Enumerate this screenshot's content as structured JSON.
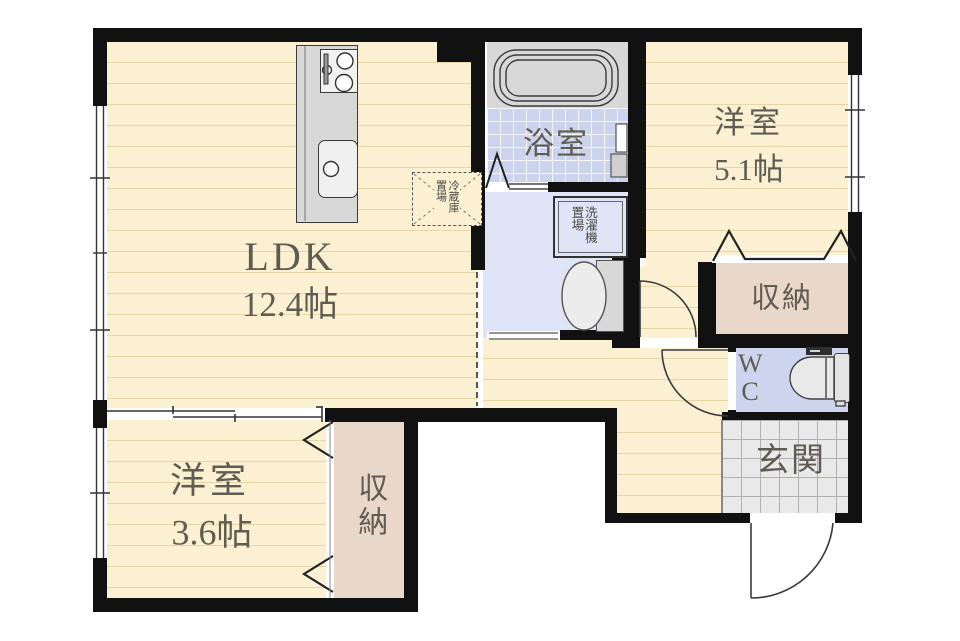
{
  "rooms": {
    "ldk": {
      "label": "LDK",
      "size": "12.4帖"
    },
    "bedroom_upper": {
      "label": "洋室",
      "size": "5.1帖"
    },
    "bedroom_lower": {
      "label": "洋室",
      "size": "3.6帖"
    },
    "bathroom": {
      "label": "浴室"
    },
    "entrance": {
      "label": "玄関"
    },
    "storage_upper": {
      "label": "収納"
    },
    "storage_lower": {
      "label": "収納"
    },
    "wc": {
      "line1": "W",
      "line2": "C"
    },
    "washer_space": {
      "label": "洗濯機置場"
    },
    "fridge_space": {
      "label": "冷蔵庫置場"
    }
  },
  "colors": {
    "wall": "#111111",
    "wood": "#fbf1d2",
    "wood-line": "#e6d5a6",
    "bath": "#ccd3ed",
    "washroom": "#dfe4f7",
    "wc": "#ccd4ee",
    "storage": "#e9d8ca",
    "entrance": "#e9e9e9",
    "entrance-grid": "#b0b0b0",
    "fixture": "#d8d8d8",
    "line": "#3a3a3a",
    "ink": "#5f5c52"
  }
}
